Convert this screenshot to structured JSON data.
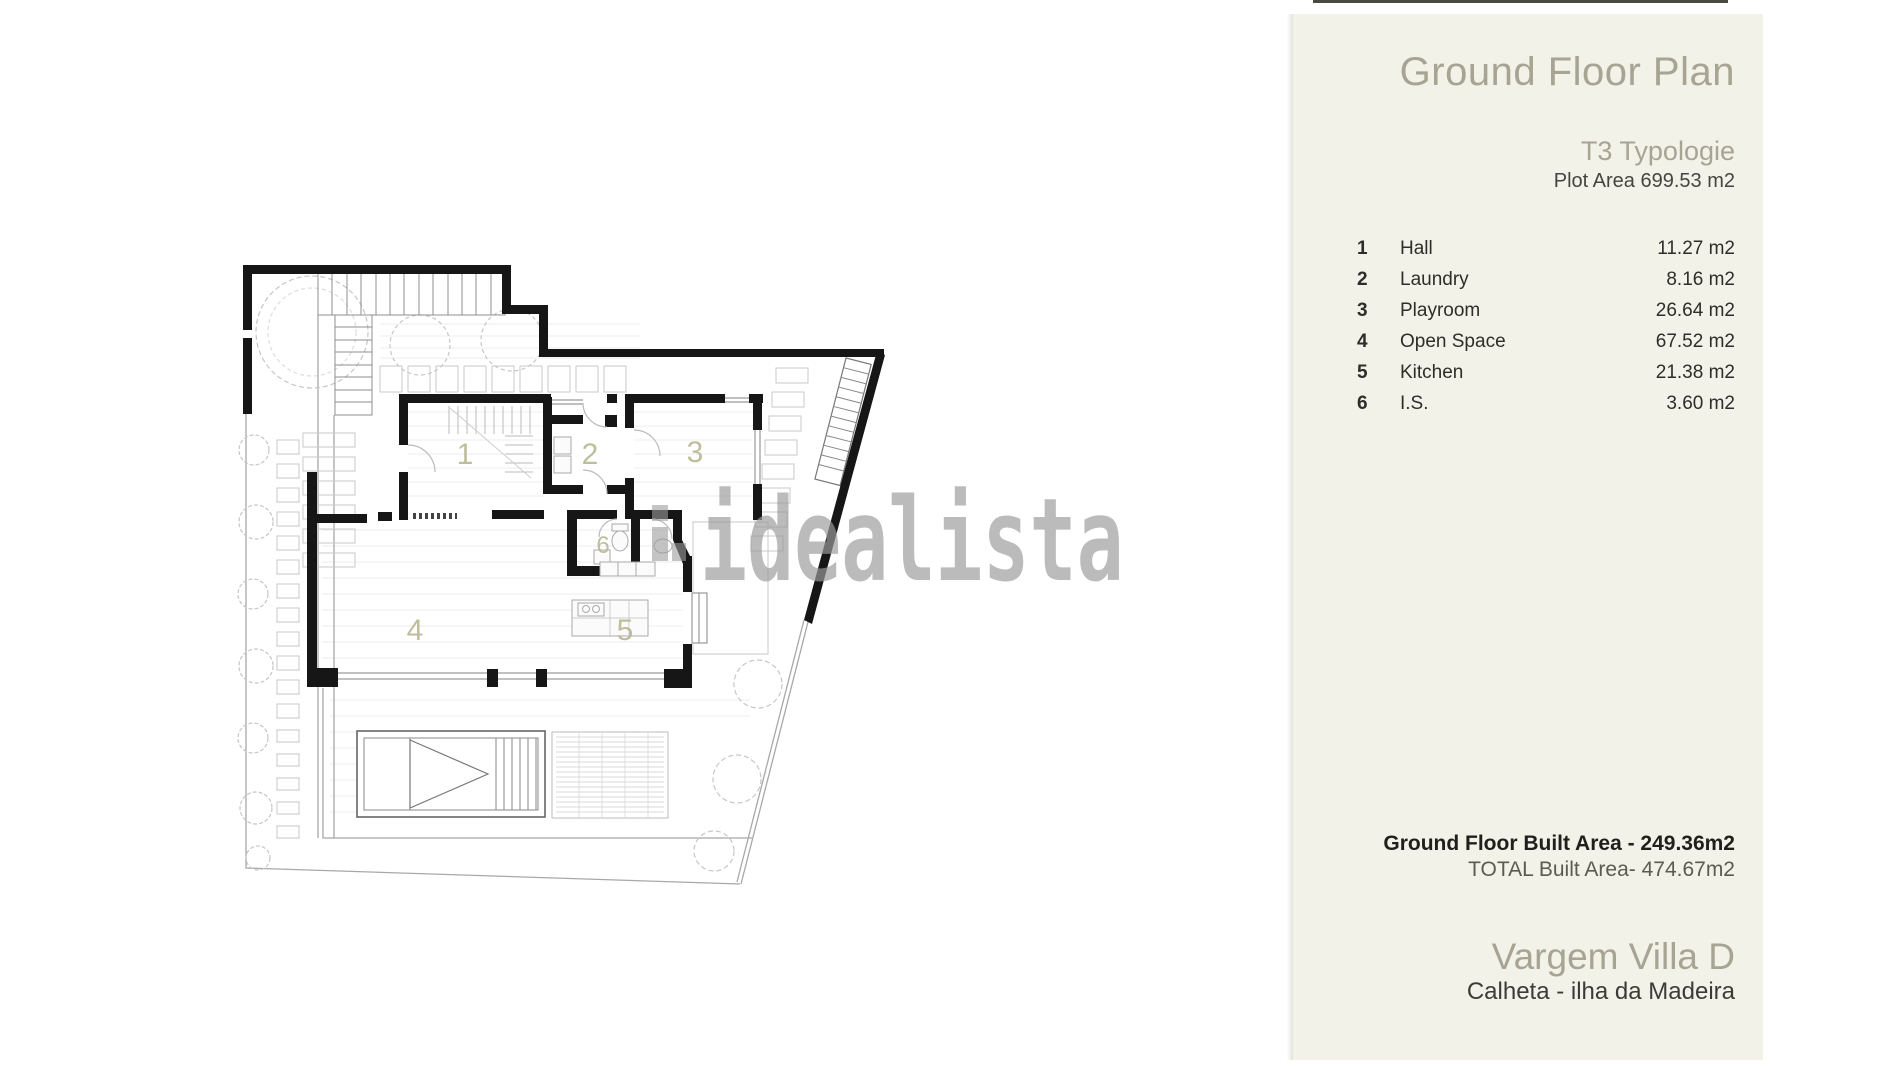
{
  "panel": {
    "title": "Ground Floor Plan",
    "typology": "T3 Typologie",
    "plot_area": "Plot Area 699.53 m2",
    "rooms": [
      {
        "num": "1",
        "name": "Hall",
        "area": "11.27 m2"
      },
      {
        "num": "2",
        "name": "Laundry",
        "area": "8.16 m2"
      },
      {
        "num": "3",
        "name": "Playroom",
        "area": "26.64 m2"
      },
      {
        "num": "4",
        "name": "Open Space",
        "area": "67.52 m2"
      },
      {
        "num": "5",
        "name": "Kitchen",
        "area": "21.38 m2"
      },
      {
        "num": "6",
        "name": "I.S.",
        "area": "3.60 m2"
      }
    ],
    "built_area": "Ground Floor Built Area - 249.36m2",
    "total_built_area": "TOTAL Built Area- 474.67m2",
    "villa_name": "Vargem Villa D",
    "villa_location": "Calheta - ilha da Madeira"
  },
  "plan": {
    "labels": [
      "1",
      "2",
      "3",
      "4",
      "5",
      "6"
    ],
    "watermark": "idealista"
  },
  "colors": {
    "panel_bg": "#f3f2e9",
    "accent_text": "#a7a493",
    "dark_text": "#2e2e29",
    "wall": "#161616",
    "room_label": "#b9bb98",
    "watermark": "#9c9c9c"
  }
}
